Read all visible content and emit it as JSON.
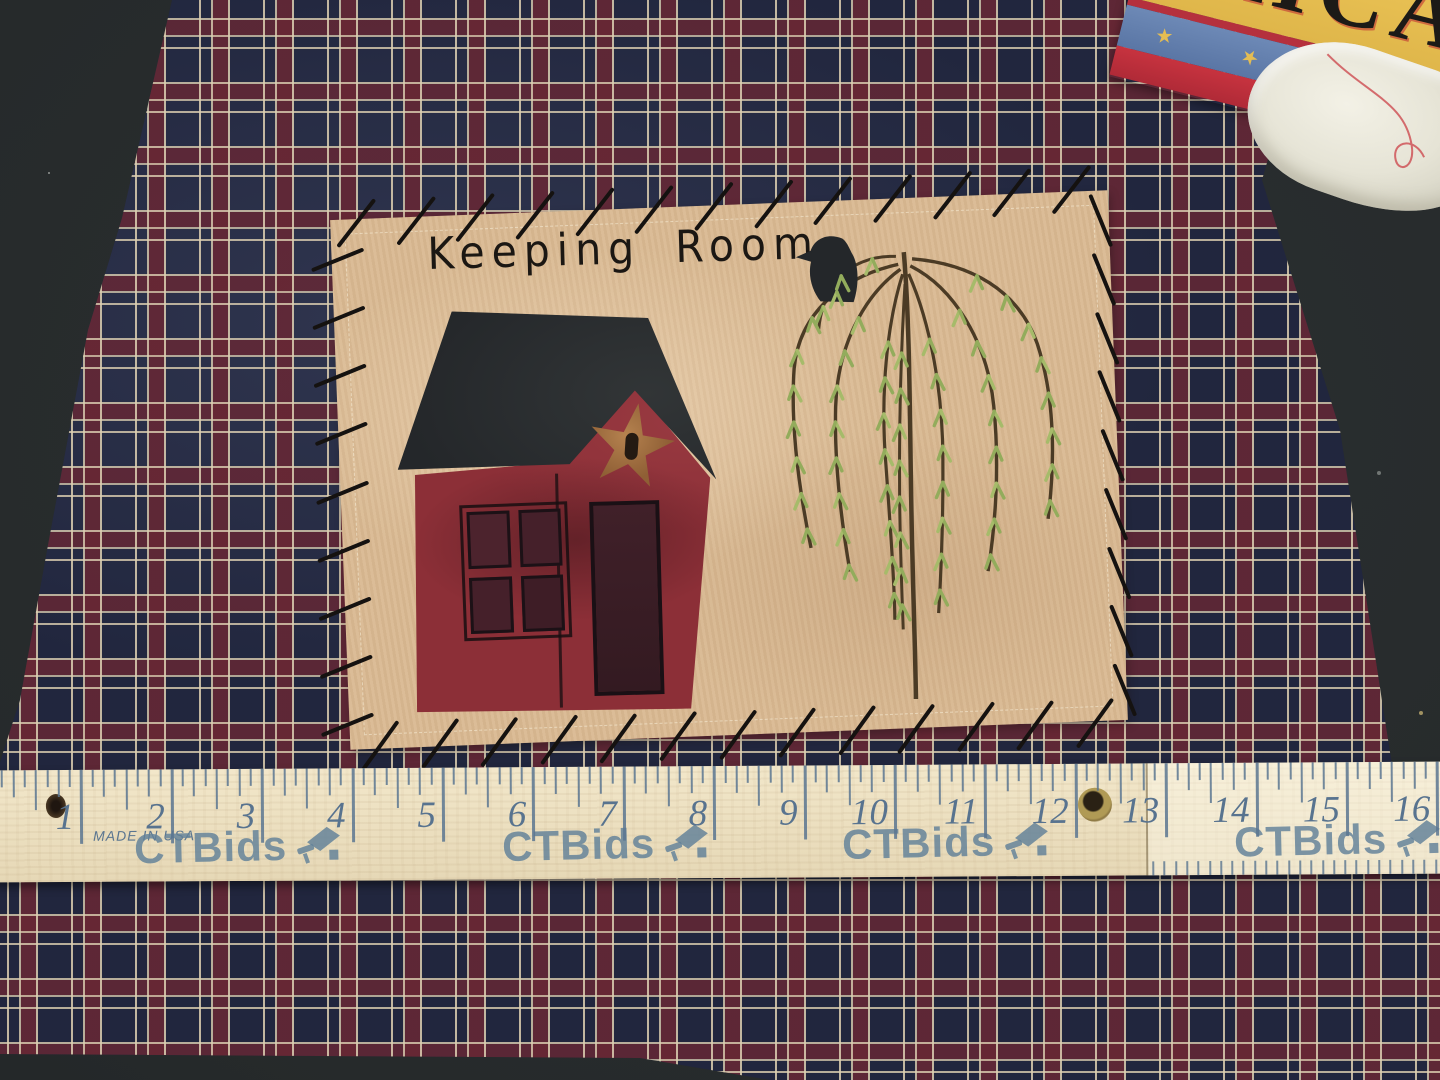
{
  "artwork": {
    "title": "Keeping Room"
  },
  "banner": {
    "text": "ERICA"
  },
  "ruler": {
    "made_in": "MADE IN USA",
    "watermark": "CTBids",
    "inch_labels": [
      "1",
      "2",
      "3",
      "4",
      "5",
      "6",
      "7",
      "8",
      "9",
      "10",
      "11",
      "12",
      "13",
      "14",
      "15",
      "16"
    ]
  },
  "colors": {
    "table": "#262a2b",
    "plaid_navy": "#252b46",
    "plaid_maroon": "#682734",
    "plaid_cream": "#dccfb2",
    "felt_tan": "#d9b992",
    "house_red": "#8c2f37",
    "roof_black": "#24272a",
    "star_copper": "#aa7848",
    "leaf_green": "#93ac5c",
    "ruler_wood": "#ecdfc0",
    "ruler_ink": "#5a7590",
    "banner_yellow": "#e8c052"
  }
}
